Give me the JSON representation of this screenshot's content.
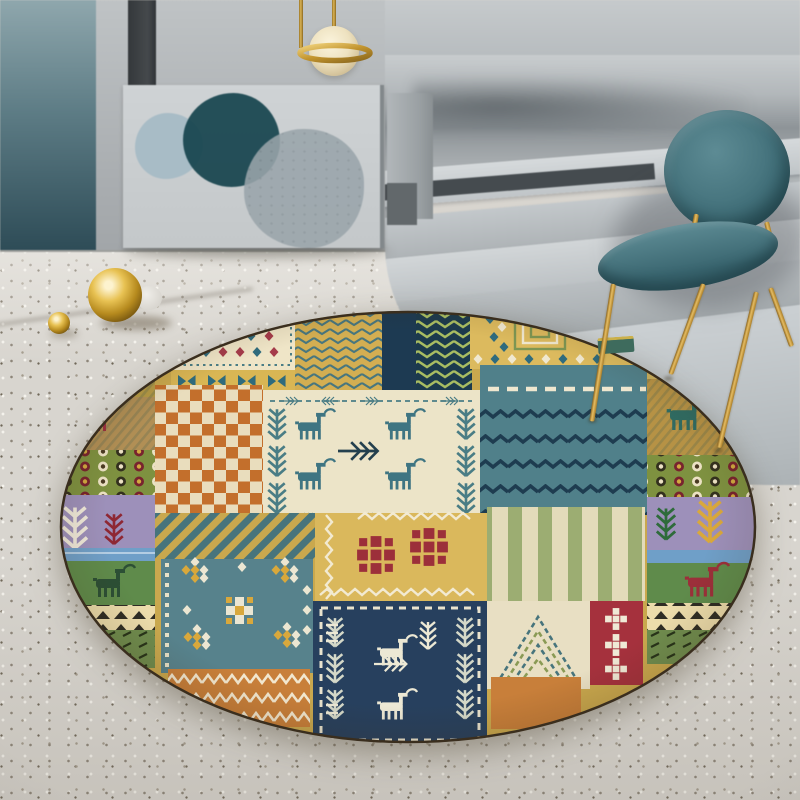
{
  "meta": {
    "title": "Round bohemian kilim patchwork rug in modern gray interior"
  },
  "palette": {
    "floor": "#d8d5cf",
    "wall": "#aeb2b5",
    "teal_panel_top": "#8fa7ad",
    "teal_panel_bottom": "#2e4c57",
    "board": "#c4c8ca",
    "art_teal": "#16434d",
    "art_steel": "#a8bcc6",
    "art_gray": "#9aa5ab",
    "step_light": "#c0c5c8",
    "step_mid": "#aeb3b6",
    "step_shadow": "#454b4f",
    "brass": "#c9992f",
    "brass_light": "#ecca70",
    "brass_dark": "#7c591a",
    "chair_teal": "#3c6a74",
    "chair_teal_dark": "#2c5560",
    "lamp_globe": "#f2e7c9",
    "rug_gold": "#c9a84e",
    "rug_orange": "#c4702c",
    "rug_teal": "#50808a",
    "rug_navy": "#1d3a52",
    "rug_navy2": "#27405e",
    "rug_cream": "#ece4c8",
    "rug_red": "#9c2f3a",
    "rug_green": "#5f8b4b",
    "rug_olive": "#7e9140",
    "rug_purple": "#9d90ba",
    "rug_blue": "#6f9fc8",
    "rug_tan": "#b18f55",
    "rug_outline": "#3a2e1e"
  },
  "scene": {
    "objects": [
      {
        "id": "pendant-lamp",
        "label": "brass pendant lamp with cream globe ring"
      },
      {
        "id": "art-board",
        "label": "leaning art board with three overlapping circles"
      },
      {
        "id": "accent-panel",
        "label": "teal gradient wall panel"
      },
      {
        "id": "steps",
        "label": "curved gray platform steps"
      },
      {
        "id": "chair",
        "label": "teal upholstered chair with brass legs"
      },
      {
        "id": "brass-spheres",
        "label": "two brass sphere ornaments on floor"
      },
      {
        "id": "rug",
        "label": "round kilim patchwork area rug"
      },
      {
        "id": "floor",
        "label": "speckled terrazzo floor"
      }
    ]
  },
  "rug": {
    "shape": "round",
    "motifs": [
      "checkerboard",
      "herringbone chevrons",
      "zigzag waves",
      "diamond clusters",
      "vertical stripes",
      "dot bands",
      "deer figures",
      "pine trees",
      "bowties",
      "concentric squares",
      "nested chevrons",
      "triangle rows",
      "dashed borders"
    ]
  }
}
